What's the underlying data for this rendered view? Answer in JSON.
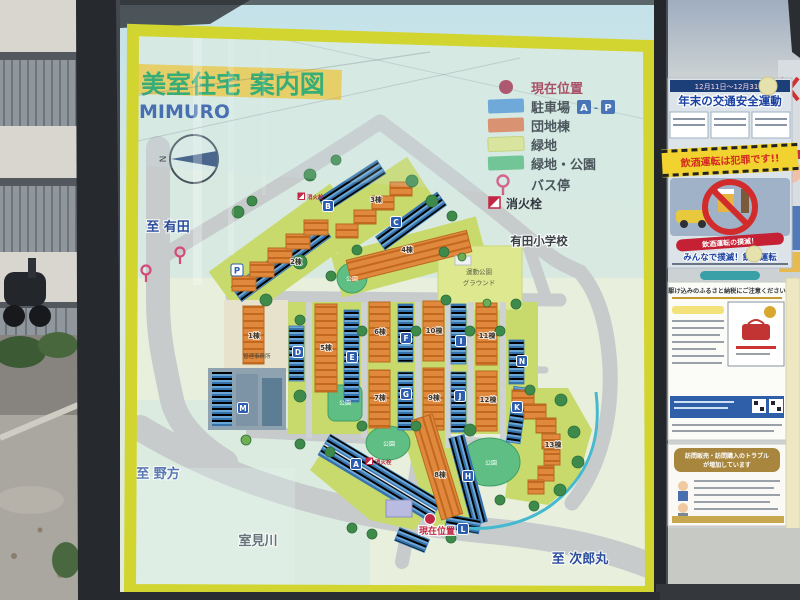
{
  "board": {
    "title": "美室住宅 案内図",
    "subtitle": "MIMURO",
    "compass_n": "N",
    "legend": {
      "current_location": "現在位置",
      "parking": "駐車場",
      "parking_a": "A",
      "parking_dash": "-",
      "parking_p": "P",
      "housing": "団地棟",
      "green": "緑地",
      "green_park": "緑地・公園",
      "bus_stop": "バス停",
      "hydrant": "消火栓"
    },
    "directions": {
      "arita": "至 有田",
      "nokata": "至 野方",
      "muromi_river": "室見川",
      "jiromaru": "至 次郎丸",
      "school": "有田小学校"
    },
    "buildings": {
      "b1": "1棟",
      "b2": "2棟",
      "b3": "3棟",
      "b4": "4棟",
      "b5": "5棟",
      "b6": "6棟",
      "b7": "7棟",
      "b8": "8棟",
      "b9": "9棟",
      "b10": "10棟",
      "b11": "11棟",
      "b12": "12棟",
      "b13": "13棟"
    },
    "labels": {
      "park": "公園",
      "sports_park_line1": "運動公園",
      "sports_park_line2": "グラウンド",
      "office": "管理事務所",
      "hydrant": "消火栓",
      "current_location": "現在位置"
    },
    "parking_letters": {
      "a": "A",
      "b": "B",
      "c": "C",
      "d": "D",
      "e": "E",
      "f": "F",
      "g": "G",
      "h": "H",
      "i": "I",
      "j": "J",
      "k": "K",
      "l": "L",
      "m": "M",
      "n": "N",
      "p": "P"
    },
    "colors": {
      "frame_yellow": "#d2d52f",
      "housing_orange": "#e0883c",
      "parking_blue": "#4e92c6",
      "green_space": "#c8da6b",
      "park_green": "#5fbe83",
      "title_green": "#17a05f",
      "direction_blue": "#2b4d9b",
      "marker_red": "#c22745"
    }
  },
  "posters": {
    "traffic_safety": {
      "dates": "12月11日〜12月31日",
      "title": "年末の交通安全運動",
      "slogan": "飲酒運転は犯罪です!!",
      "ribbon": "飲酒運転の撲滅！",
      "footer": "みんなで撲滅！飲酒運転"
    },
    "furusato_flyer": {
      "title": "駆け込みのふるさと納税にご注意ください"
    },
    "sales_flyer": {
      "title_line1": "訪問販売・訪問購入のトラブル",
      "title_line2": "が増加しています"
    }
  }
}
